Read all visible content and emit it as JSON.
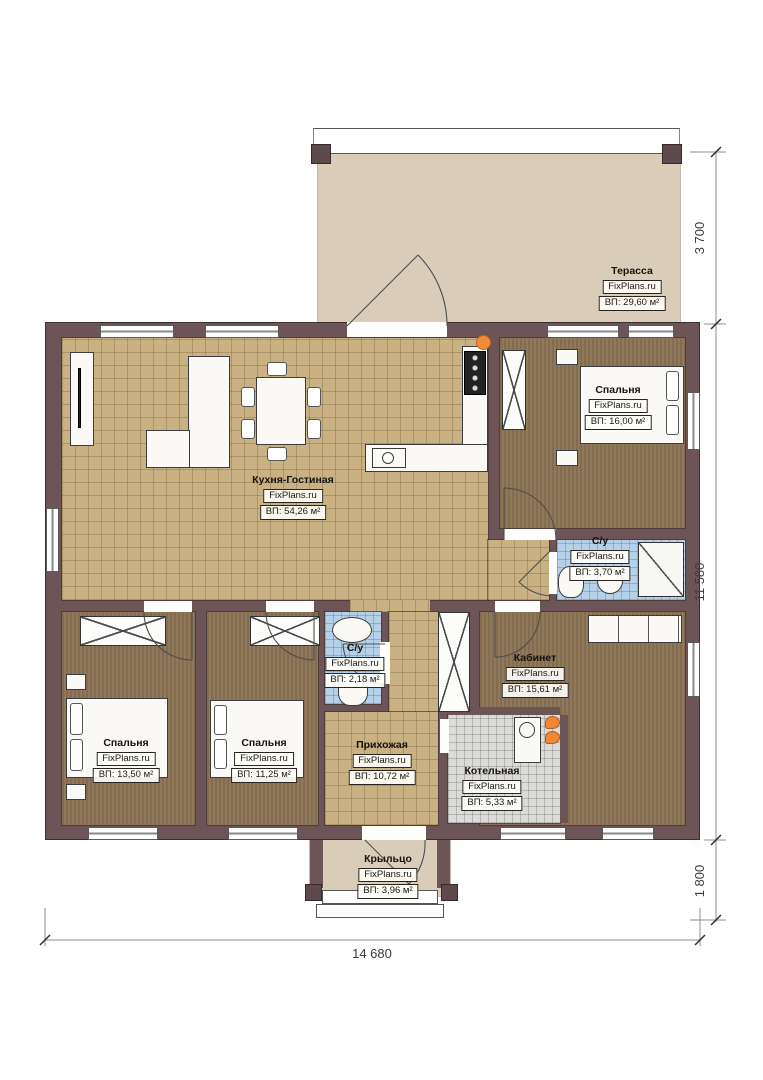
{
  "rooms": [
    {
      "name": "Терасса",
      "brand": "FixPlans.ru",
      "area": "ВП: 29,60 м²"
    },
    {
      "name": "Спальня",
      "brand": "FixPlans.ru",
      "area": "ВП: 16,00 м²"
    },
    {
      "name": "Кухня-Гостиная",
      "brand": "FixPlans.ru",
      "area": "ВП: 54,26 м²"
    },
    {
      "name": "С/у",
      "brand": "FixPlans.ru",
      "area": "ВП: 3,70 м²"
    },
    {
      "name": "С/у",
      "brand": "FixPlans.ru",
      "area": "ВП: 2,18 м²"
    },
    {
      "name": "Кабинет",
      "brand": "FixPlans.ru",
      "area": "ВП: 15,61 м²"
    },
    {
      "name": "Спальня",
      "brand": "FixPlans.ru",
      "area": "ВП: 13,50 м²"
    },
    {
      "name": "Спальня",
      "brand": "FixPlans.ru",
      "area": "ВП: 11,25 м²"
    },
    {
      "name": "Прихожая",
      "brand": "FixPlans.ru",
      "area": "ВП: 10,72 м²"
    },
    {
      "name": "Котельная",
      "brand": "FixPlans.ru",
      "area": "ВП: 5,33 м²"
    },
    {
      "name": "Крыльцо",
      "brand": "FixPlans.ru",
      "area": "ВП: 3,96 м²"
    }
  ],
  "dims": {
    "v1": "3 700",
    "v2": "11 580",
    "v3": "1 800",
    "h1": "14 680"
  },
  "colors": {
    "wall": "#6d5456",
    "tile_beige": "#c9b183",
    "floor_brown": "#8b7254",
    "tile_blue": "#b5d1e9",
    "tile_gray": "#dbdbd9",
    "terrace": "#d9cdb9",
    "accent_orange": "#ef8c3a"
  }
}
